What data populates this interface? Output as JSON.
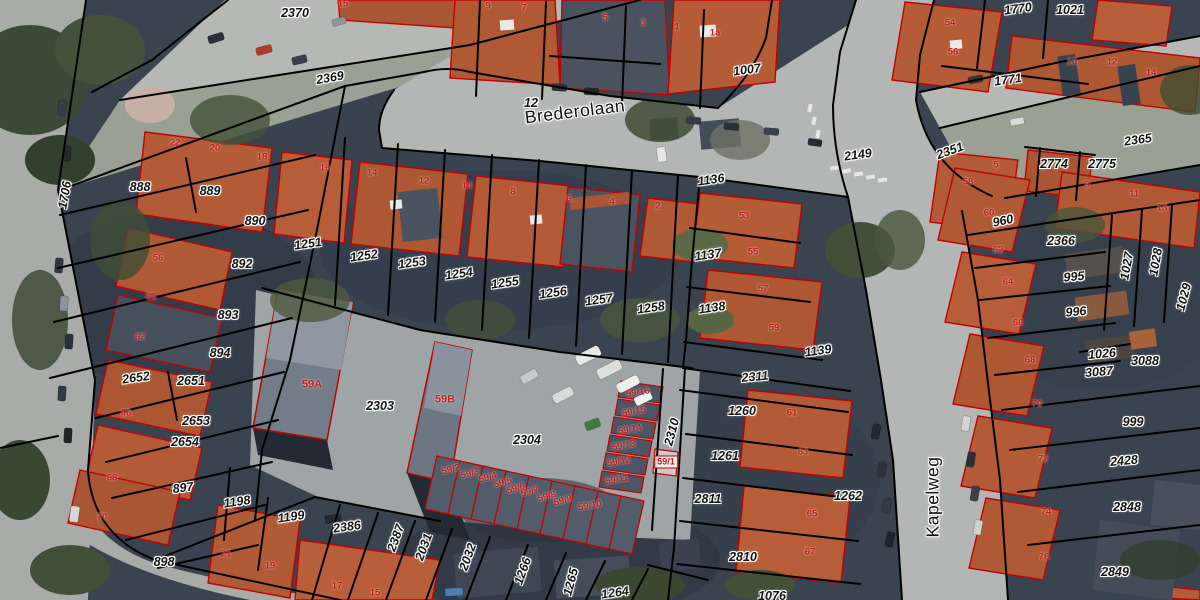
{
  "map": {
    "streets": [
      {
        "text": "Brederolaan",
        "x": 575,
        "y": 112,
        "rot": -7
      },
      {
        "text": "Kapelweg",
        "x": 933,
        "y": 497,
        "rot": -90
      }
    ],
    "parcel_labels": [
      {
        "text": "2370",
        "x": 295,
        "y": 13,
        "rot": 0
      },
      {
        "text": "2369",
        "x": 330,
        "y": 78,
        "rot": -10
      },
      {
        "text": "12",
        "x": 531,
        "y": 103,
        "rot": 0
      },
      {
        "text": "1007",
        "x": 747,
        "y": 70,
        "rot": -8
      },
      {
        "text": "1770",
        "x": 1018,
        "y": 9,
        "rot": -8
      },
      {
        "text": "1021",
        "x": 1070,
        "y": 10,
        "rot": 0
      },
      {
        "text": "1771",
        "x": 1008,
        "y": 80,
        "rot": -8
      },
      {
        "text": "2149",
        "x": 858,
        "y": 155,
        "rot": -8
      },
      {
        "text": "2351",
        "x": 950,
        "y": 151,
        "rot": -20
      },
      {
        "text": "2365",
        "x": 1138,
        "y": 140,
        "rot": -8
      },
      {
        "text": "2774",
        "x": 1054,
        "y": 164,
        "rot": 0
      },
      {
        "text": "2775",
        "x": 1102,
        "y": 164,
        "rot": 0
      },
      {
        "text": "1706",
        "x": 65,
        "y": 195,
        "rot": -80
      },
      {
        "text": "888",
        "x": 140,
        "y": 187,
        "rot": 0
      },
      {
        "text": "889",
        "x": 210,
        "y": 191,
        "rot": 0
      },
      {
        "text": "890",
        "x": 255,
        "y": 221,
        "rot": 0
      },
      {
        "text": "892",
        "x": 242,
        "y": 264,
        "rot": 0
      },
      {
        "text": "893",
        "x": 228,
        "y": 315,
        "rot": 0
      },
      {
        "text": "894",
        "x": 220,
        "y": 353,
        "rot": 0
      },
      {
        "text": "2652",
        "x": 136,
        "y": 378,
        "rot": -8
      },
      {
        "text": "2651",
        "x": 191,
        "y": 381,
        "rot": 0
      },
      {
        "text": "2653",
        "x": 196,
        "y": 421,
        "rot": 0
      },
      {
        "text": "2654",
        "x": 185,
        "y": 442,
        "rot": 0
      },
      {
        "text": "897",
        "x": 183,
        "y": 488,
        "rot": -8
      },
      {
        "text": "1198",
        "x": 237,
        "y": 502,
        "rot": -8
      },
      {
        "text": "1199",
        "x": 291,
        "y": 517,
        "rot": -8
      },
      {
        "text": "898",
        "x": 164,
        "y": 562,
        "rot": 0
      },
      {
        "text": "1251",
        "x": 308,
        "y": 244,
        "rot": -8
      },
      {
        "text": "1252",
        "x": 364,
        "y": 256,
        "rot": -8
      },
      {
        "text": "1253",
        "x": 412,
        "y": 263,
        "rot": -8
      },
      {
        "text": "1254",
        "x": 459,
        "y": 274,
        "rot": -8
      },
      {
        "text": "1255",
        "x": 505,
        "y": 283,
        "rot": -8
      },
      {
        "text": "1256",
        "x": 553,
        "y": 293,
        "rot": -8
      },
      {
        "text": "1257",
        "x": 599,
        "y": 300,
        "rot": -8
      },
      {
        "text": "1258",
        "x": 651,
        "y": 308,
        "rot": -8
      },
      {
        "text": "1136",
        "x": 711,
        "y": 180,
        "rot": -8
      },
      {
        "text": "1137",
        "x": 708,
        "y": 255,
        "rot": -8
      },
      {
        "text": "1138",
        "x": 712,
        "y": 308,
        "rot": -8
      },
      {
        "text": "1139",
        "x": 818,
        "y": 351,
        "rot": -8
      },
      {
        "text": "2311",
        "x": 755,
        "y": 377,
        "rot": -5
      },
      {
        "text": "2303",
        "x": 380,
        "y": 406,
        "rot": 0
      },
      {
        "text": "2304",
        "x": 527,
        "y": 440,
        "rot": 0
      },
      {
        "text": "1260",
        "x": 742,
        "y": 411,
        "rot": 0
      },
      {
        "text": "1261",
        "x": 725,
        "y": 456,
        "rot": 0
      },
      {
        "text": "2310",
        "x": 672,
        "y": 432,
        "rot": -75
      },
      {
        "text": "2811",
        "x": 708,
        "y": 499,
        "rot": 0
      },
      {
        "text": "1262",
        "x": 848,
        "y": 496,
        "rot": 0
      },
      {
        "text": "2810",
        "x": 743,
        "y": 557,
        "rot": 0
      },
      {
        "text": "1076",
        "x": 772,
        "y": 596,
        "rot": 0
      },
      {
        "text": "960",
        "x": 1003,
        "y": 221,
        "rot": -12
      },
      {
        "text": "2366",
        "x": 1061,
        "y": 241,
        "rot": 0
      },
      {
        "text": "995",
        "x": 1074,
        "y": 277,
        "rot": -5
      },
      {
        "text": "996",
        "x": 1076,
        "y": 312,
        "rot": -5
      },
      {
        "text": "1027",
        "x": 1127,
        "y": 266,
        "rot": -80
      },
      {
        "text": "1028",
        "x": 1156,
        "y": 262,
        "rot": -80
      },
      {
        "text": "1029",
        "x": 1184,
        "y": 297,
        "rot": -75
      },
      {
        "text": "1026",
        "x": 1102,
        "y": 354,
        "rot": -5
      },
      {
        "text": "3088",
        "x": 1145,
        "y": 361,
        "rot": 0
      },
      {
        "text": "3087",
        "x": 1099,
        "y": 372,
        "rot": -5
      },
      {
        "text": "999",
        "x": 1133,
        "y": 422,
        "rot": 0
      },
      {
        "text": "2428",
        "x": 1124,
        "y": 461,
        "rot": -5
      },
      {
        "text": "2848",
        "x": 1127,
        "y": 507,
        "rot": 0
      },
      {
        "text": "2849",
        "x": 1115,
        "y": 572,
        "rot": 0
      },
      {
        "text": "2386",
        "x": 347,
        "y": 527,
        "rot": -8
      },
      {
        "text": "2387",
        "x": 396,
        "y": 538,
        "rot": -70
      },
      {
        "text": "2031",
        "x": 424,
        "y": 547,
        "rot": -70
      },
      {
        "text": "2032",
        "x": 468,
        "y": 557,
        "rot": -70
      },
      {
        "text": "1266",
        "x": 523,
        "y": 571,
        "rot": -70
      },
      {
        "text": "1265",
        "x": 571,
        "y": 582,
        "rot": -75
      },
      {
        "text": "1264",
        "x": 615,
        "y": 593,
        "rot": -8
      }
    ],
    "house_numbers": [
      {
        "text": "15",
        "x": 343,
        "y": 4,
        "rot": 0
      },
      {
        "text": "9",
        "x": 488,
        "y": 6,
        "rot": 0
      },
      {
        "text": "7",
        "x": 524,
        "y": 8,
        "rot": 0
      },
      {
        "text": "5",
        "x": 605,
        "y": 18,
        "rot": 0
      },
      {
        "text": "3",
        "x": 643,
        "y": 23,
        "rot": 0
      },
      {
        "text": "1",
        "x": 677,
        "y": 27,
        "rot": 0
      },
      {
        "text": "1a",
        "x": 715,
        "y": 33,
        "rot": 0
      },
      {
        "text": "22",
        "x": 175,
        "y": 143,
        "rot": 0
      },
      {
        "text": "20",
        "x": 215,
        "y": 148,
        "rot": 0
      },
      {
        "text": "18",
        "x": 262,
        "y": 157,
        "rot": 0
      },
      {
        "text": "16",
        "x": 325,
        "y": 168,
        "rot": 0
      },
      {
        "text": "14",
        "x": 372,
        "y": 173,
        "rot": 0
      },
      {
        "text": "12",
        "x": 424,
        "y": 181,
        "rot": 0
      },
      {
        "text": "10",
        "x": 467,
        "y": 186,
        "rot": 0
      },
      {
        "text": "8",
        "x": 513,
        "y": 192,
        "rot": 0
      },
      {
        "text": "6",
        "x": 569,
        "y": 199,
        "rot": 0
      },
      {
        "text": "4",
        "x": 612,
        "y": 202,
        "rot": 0
      },
      {
        "text": "2",
        "x": 658,
        "y": 206,
        "rot": 0
      },
      {
        "text": "56",
        "x": 158,
        "y": 258,
        "rot": 0
      },
      {
        "text": "60",
        "x": 151,
        "y": 297,
        "rot": 0
      },
      {
        "text": "62",
        "x": 140,
        "y": 337,
        "rot": 0
      },
      {
        "text": "66",
        "x": 126,
        "y": 413,
        "rot": 0
      },
      {
        "text": "68",
        "x": 112,
        "y": 478,
        "rot": 0
      },
      {
        "text": "70",
        "x": 102,
        "y": 517,
        "rot": 0
      },
      {
        "text": "21",
        "x": 226,
        "y": 554,
        "rot": 0
      },
      {
        "text": "19",
        "x": 270,
        "y": 566,
        "rot": 0
      },
      {
        "text": "17",
        "x": 337,
        "y": 586,
        "rot": 0
      },
      {
        "text": "15",
        "x": 375,
        "y": 593,
        "rot": 0
      },
      {
        "text": "59A",
        "x": 312,
        "y": 385,
        "rot": 0,
        "big": true
      },
      {
        "text": "59B",
        "x": 445,
        "y": 400,
        "rot": 0,
        "big": true
      },
      {
        "text": "53",
        "x": 744,
        "y": 216,
        "rot": 0
      },
      {
        "text": "55",
        "x": 753,
        "y": 252,
        "rot": 0
      },
      {
        "text": "57",
        "x": 763,
        "y": 289,
        "rot": 0
      },
      {
        "text": "59",
        "x": 774,
        "y": 328,
        "rot": 0
      },
      {
        "text": "61",
        "x": 792,
        "y": 413,
        "rot": 0
      },
      {
        "text": "63",
        "x": 803,
        "y": 452,
        "rot": 0
      },
      {
        "text": "65",
        "x": 812,
        "y": 514,
        "rot": 0
      },
      {
        "text": "67",
        "x": 810,
        "y": 552,
        "rot": 0
      },
      {
        "text": "59/16",
        "x": 638,
        "y": 393,
        "rot": -10
      },
      {
        "text": "59/15",
        "x": 634,
        "y": 412,
        "rot": -10
      },
      {
        "text": "59/14",
        "x": 630,
        "y": 430,
        "rot": -10
      },
      {
        "text": "59/13",
        "x": 624,
        "y": 446,
        "rot": -10
      },
      {
        "text": "59/12",
        "x": 619,
        "y": 462,
        "rot": -10
      },
      {
        "text": "59/11",
        "x": 617,
        "y": 480,
        "rot": -10
      },
      {
        "text": "59/1",
        "x": 666,
        "y": 462,
        "rot": 0,
        "boxed": true
      },
      {
        "text": "59/2",
        "x": 451,
        "y": 470,
        "rot": -15
      },
      {
        "text": "59/3",
        "x": 470,
        "y": 474,
        "rot": -15
      },
      {
        "text": "59/4",
        "x": 488,
        "y": 478,
        "rot": -15
      },
      {
        "text": "59/5",
        "x": 503,
        "y": 483,
        "rot": -15
      },
      {
        "text": "59/6",
        "x": 516,
        "y": 489,
        "rot": -15
      },
      {
        "text": "59/7",
        "x": 530,
        "y": 492,
        "rot": -15
      },
      {
        "text": "59/8",
        "x": 547,
        "y": 497,
        "rot": -15
      },
      {
        "text": "59/9",
        "x": 563,
        "y": 501,
        "rot": -15
      },
      {
        "text": "59/10",
        "x": 590,
        "y": 506,
        "rot": -10
      },
      {
        "text": "54",
        "x": 950,
        "y": 23,
        "rot": 0
      },
      {
        "text": "56",
        "x": 953,
        "y": 52,
        "rot": 0
      },
      {
        "text": "10",
        "x": 1072,
        "y": 62,
        "rot": 0
      },
      {
        "text": "12",
        "x": 1112,
        "y": 62,
        "rot": 0
      },
      {
        "text": "14",
        "x": 1151,
        "y": 73,
        "rot": 0
      },
      {
        "text": "5",
        "x": 996,
        "y": 165,
        "rot": 0
      },
      {
        "text": "58",
        "x": 968,
        "y": 182,
        "rot": 0
      },
      {
        "text": "9",
        "x": 1087,
        "y": 185,
        "rot": 0
      },
      {
        "text": "11",
        "x": 1134,
        "y": 194,
        "rot": 0
      },
      {
        "text": "13",
        "x": 1162,
        "y": 208,
        "rot": 0
      },
      {
        "text": "60",
        "x": 989,
        "y": 213,
        "rot": 0
      },
      {
        "text": "62",
        "x": 998,
        "y": 250,
        "rot": 0
      },
      {
        "text": "64",
        "x": 1008,
        "y": 282,
        "rot": 0
      },
      {
        "text": "66",
        "x": 1018,
        "y": 323,
        "rot": 0
      },
      {
        "text": "68",
        "x": 1030,
        "y": 360,
        "rot": 0
      },
      {
        "text": "70",
        "x": 1037,
        "y": 404,
        "rot": 0
      },
      {
        "text": "72",
        "x": 1043,
        "y": 459,
        "rot": 0
      },
      {
        "text": "74",
        "x": 1046,
        "y": 512,
        "rot": 0
      },
      {
        "text": "76",
        "x": 1044,
        "y": 557,
        "rot": 0
      }
    ],
    "colors": {
      "parcel_line": "#000000",
      "building_outline": "#c40000",
      "parcel_label": "#141414",
      "house_number": "#c2201b",
      "road": "#b5b7b5",
      "roof_orange": "#b25b36",
      "warehouse": "#737d89"
    }
  }
}
